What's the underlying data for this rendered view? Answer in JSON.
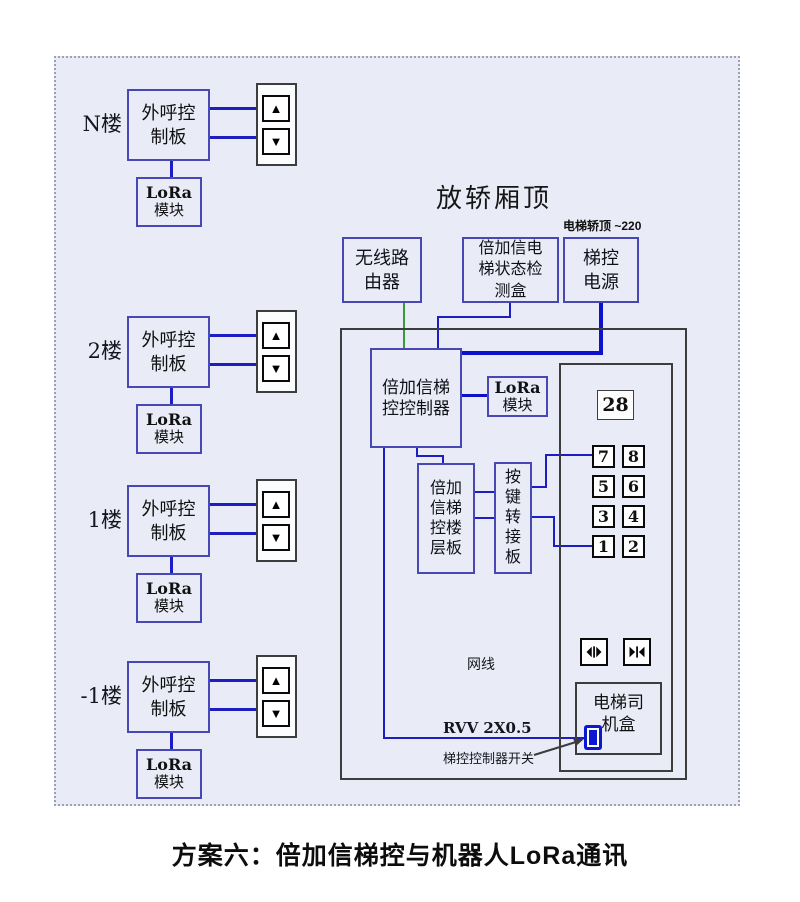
{
  "window": {
    "caption": "方案六：倍加信梯控与机器人LoRa通讯"
  },
  "icons": {
    "up": "▲",
    "down": "▼"
  },
  "floors": [
    {
      "label": "N楼",
      "board": "外呼控制板",
      "lora_line1": "LoRa",
      "lora_line2": "模块"
    },
    {
      "label": "2楼",
      "board": "外呼控制板",
      "lora_line1": "LoRa",
      "lora_line2": "模块"
    },
    {
      "label": "1楼",
      "board": "外呼控制板",
      "lora_line1": "LoRa",
      "lora_line2": "模块"
    },
    {
      "label": "-1楼",
      "board": "外呼控制板",
      "lora_line1": "LoRa",
      "lora_line2": "模块"
    }
  ],
  "car_top": {
    "title": "放轿厢顶",
    "power_note": "电梯轿顶 ~220",
    "router": "无线路由器",
    "detector": "倍加信电梯状态检测盒",
    "power": "梯控电源",
    "controller": "倍加信梯控控制器",
    "lora_line1": "LoRa",
    "lora_line2": "模块",
    "floor_board": "倍加信梯控楼层板",
    "key_adapter": "按键转接板",
    "display": "28",
    "buttons": [
      "7",
      "8",
      "5",
      "6",
      "3",
      "4",
      "1",
      "2"
    ],
    "network_label": "网线",
    "rvv_label": "RVV 2X0.5",
    "switch_label": "梯控控制器开关",
    "driver_box": "电梯司机盒"
  },
  "colors": {
    "background": "#e9ecf6",
    "box_border": "#4747b6",
    "wire_blue": "#1d1dc4",
    "wire_thick_blue": "#0d10cc",
    "wire_green": "#3a9a3a",
    "switch_blue": "#0b18cf"
  }
}
